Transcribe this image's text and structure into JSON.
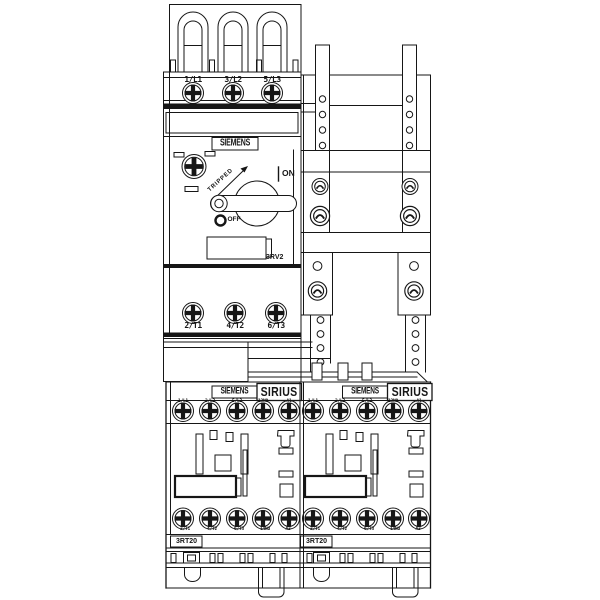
{
  "page": {
    "background": "#ffffff",
    "line_color": "#161616"
  },
  "breaker": {
    "brand_label": "SIEMENS",
    "model_label": "3RV2",
    "top_terminals": [
      "1/L1",
      "3/L2",
      "5/L3"
    ],
    "bottom_terminals": [
      "2/T1",
      "4/T2",
      "6/T3"
    ],
    "tripped_label": "TRIPPED",
    "on_label": "ON",
    "off_label": "OFF"
  },
  "contactors": {
    "left": {
      "brand_label": "SIEMENS",
      "series_label": "SIRIUS",
      "model_label": "3RT20",
      "top_terminals": [
        "1/L1",
        "3/L2",
        "5/L3",
        "13NO",
        "A1"
      ],
      "bottom_terminals": [
        "2/T1",
        "4/T2",
        "6/T3",
        "14NO",
        "A2"
      ]
    },
    "right": {
      "brand_label": "SIEMENS",
      "series_label": "SIRIUS",
      "model_label": "3RT20",
      "top_terminals": [
        "1/L1",
        "3/L2",
        "5/L3",
        "13NO",
        "A1"
      ],
      "bottom_terminals": [
        "2/T1",
        "4/T2",
        "6/T3",
        "14NO",
        "A2"
      ]
    }
  }
}
